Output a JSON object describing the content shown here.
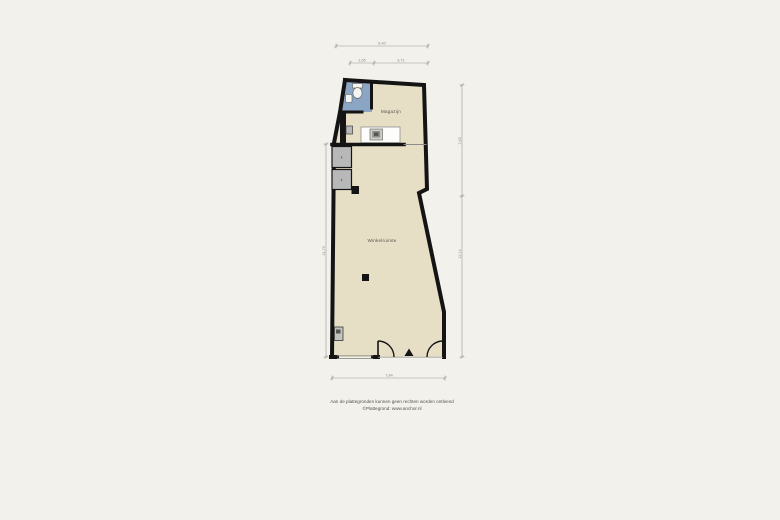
{
  "page": {
    "background": "#f2f1ec"
  },
  "plan": {
    "type": "floorplan",
    "rooms": [
      {
        "id": "magazijn",
        "label": "Magazijn"
      },
      {
        "id": "winkelruimte",
        "label": "Winkelruimte"
      },
      {
        "id": "toilet",
        "label": ""
      }
    ],
    "fixtures": [
      "toilet-icon",
      "sink-icon",
      "kitchenette-icon",
      "closet",
      "closet",
      "pillar",
      "pillar",
      "meter-box-icon",
      "entrance-arrow-icon",
      "door-arc-left",
      "door-arc-right",
      "storefront-window"
    ],
    "closets": {
      "label": "k"
    },
    "dimensions": {
      "top_total": "6,40",
      "top_seg1": "1,65",
      "top_seg2": "3,71",
      "right_top": "7,63",
      "right_bottom": "11,14",
      "left_total": "14,79",
      "bottom_total": "7,84"
    },
    "colors": {
      "floor": "#e6dfc6",
      "bathroom": "#8ba5c4",
      "wall": "#141414",
      "fixture_gray": "#b8b8b8",
      "dimension_gray": "#9a9a96",
      "counter_white": "#fdfdfb"
    }
  },
  "footer": {
    "line1": "Aan de plattegronden kunnen geen rechten worden ontleend",
    "line2": "©Plattegrond: www.anchor.nl"
  }
}
